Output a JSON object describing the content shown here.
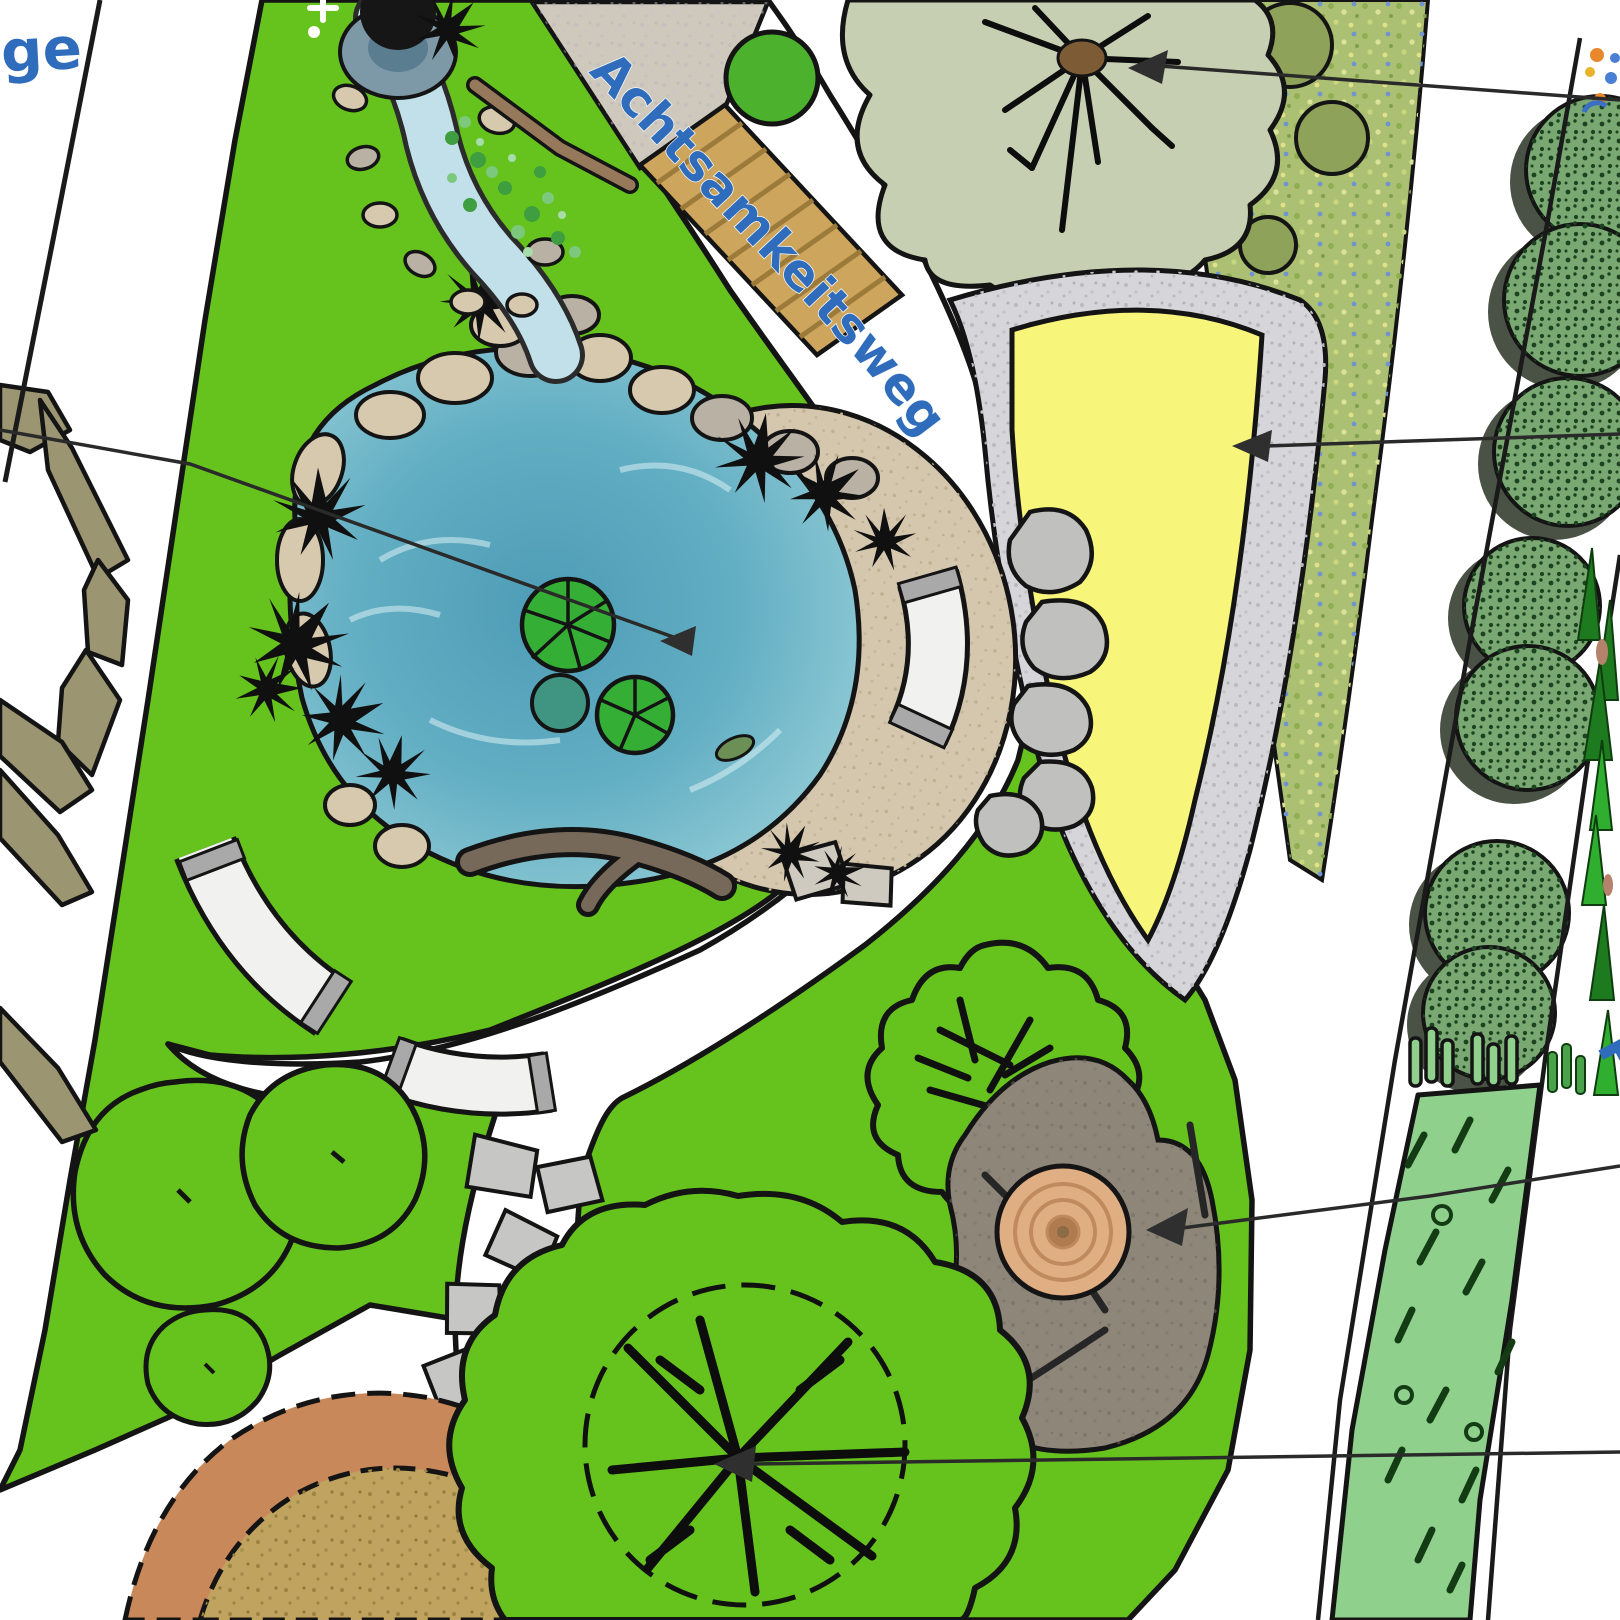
{
  "plan": {
    "path_label": "Achtsamkeitsweg",
    "edge_label_left": "ge",
    "edge_label_right": "P"
  },
  "palette": {
    "ink": "#141414",
    "label_blue": "#2f6cbb",
    "lawn": "#66c31d",
    "water_dark": "#4e9cb6",
    "water_light": "#b5dde4",
    "stream": "#c2e0ea",
    "sand": "#d5c7ad",
    "sand_yellow": "#f8f57b",
    "gravel": "#d6d6da",
    "sage_tree": "#c7cfb3",
    "meadow": "#abc073",
    "shrub": "#79a873",
    "shrub_shadow": "#4a5246",
    "perennial": "#8fd08d",
    "clay_ring": "#c9885a",
    "clay_fill": "#bfa35e",
    "deadwood": "#9b9572",
    "rock": "#8d8679",
    "log_wood": "#e0ae83",
    "bridge_wood": "#cda55d",
    "stone_tan": "#d7c9ae",
    "stone_gray": "#b9b1a4",
    "boulder": "#c0c0be",
    "bench_white": "#f1f1ef",
    "lily_green": "#35ae35"
  }
}
